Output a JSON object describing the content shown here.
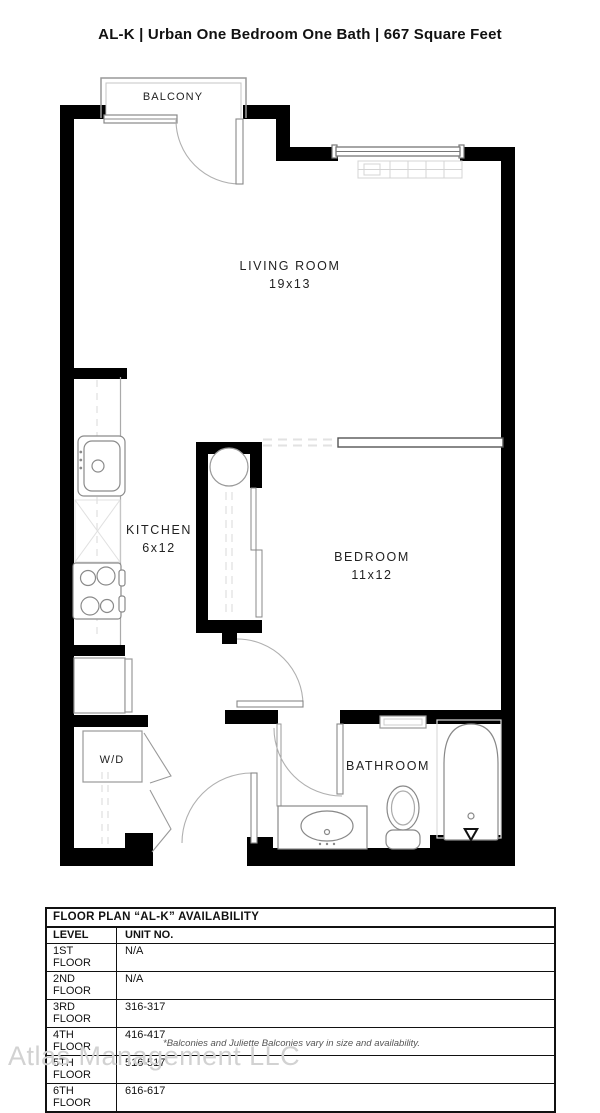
{
  "title": "AL-K | Urban One Bedroom One Bath | 667 Square Feet",
  "rooms": {
    "balcony": {
      "name": "BALCONY"
    },
    "living": {
      "name": "LIVING ROOM",
      "dims": "19x13"
    },
    "kitchen": {
      "name": "KITCHEN",
      "dims": "6x12"
    },
    "bedroom": {
      "name": "BEDROOM",
      "dims": "11x12"
    },
    "bathroom": {
      "name": "BATHROOM"
    },
    "laundry": {
      "name": "W/D"
    }
  },
  "availability_table": {
    "title": "FLOOR PLAN “AL-K” AVAILABILITY",
    "columns": {
      "level": "LEVEL",
      "unit": "UNIT NO."
    },
    "rows": [
      {
        "level": "1ST FLOOR",
        "unit": "N/A"
      },
      {
        "level": "2ND FLOOR",
        "unit": "N/A"
      },
      {
        "level": "3RD FLOOR",
        "unit": "316-317"
      },
      {
        "level": "4TH FLOOR",
        "unit": "416-417"
      },
      {
        "level": "5TH FLOOR",
        "unit": "516-517"
      },
      {
        "level": "6TH FLOOR",
        "unit": "616-617"
      }
    ]
  },
  "footer": {
    "disclaimer": "*Balconies and Juliette Balconies vary in size and availability.",
    "watermark": "Atlas Management LLC"
  },
  "colors": {
    "wall": "#000000",
    "thin_line": "#888888",
    "light_line": "#e0e0e0",
    "text": "#1a1a1a",
    "watermark": "#d2d2d2"
  }
}
